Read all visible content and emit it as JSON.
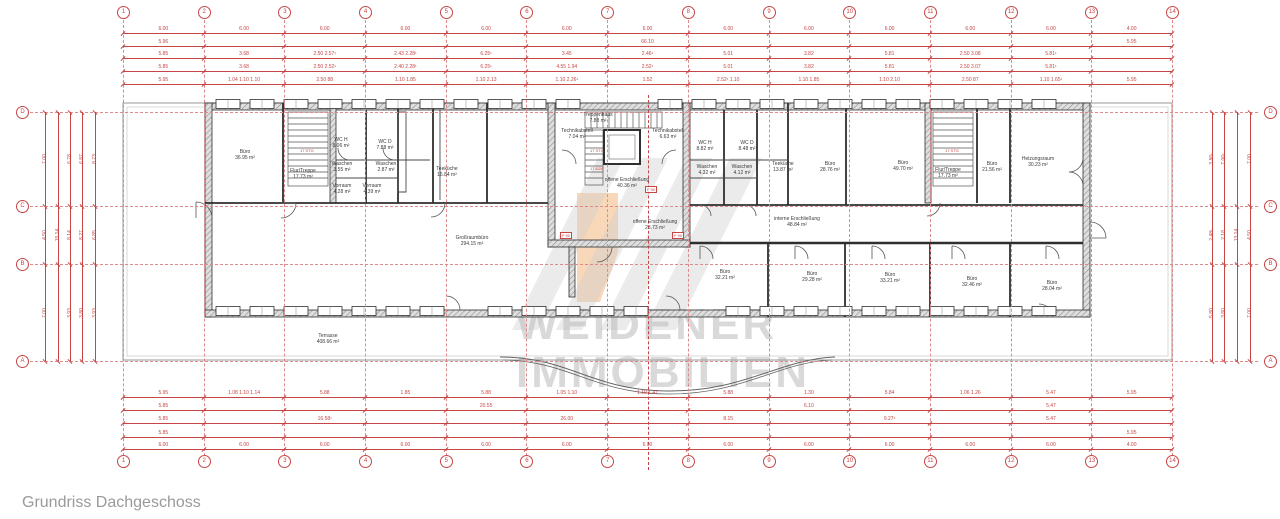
{
  "caption": "Grundriss Dachgeschoss",
  "watermark": {
    "line1": "WEIDENER",
    "line2": "IMMOBILIEN"
  },
  "colors": {
    "dim_red": "#c64545",
    "dash_red": "#dc8a8a",
    "wall_dark": "#2f2f2f",
    "outline_gray": "#999999",
    "watermark_gray": "#bdbdbd",
    "watermark_orange": "#f2a764",
    "caption_gray": "#9a9a9a"
  },
  "grid": {
    "columns": [
      "1",
      "2",
      "3",
      "4",
      "5",
      "6",
      "7",
      "8",
      "9",
      "10",
      "11",
      "12",
      "13",
      "14"
    ],
    "rows": [
      {
        "label": "D",
        "y": 112
      },
      {
        "label": "C",
        "y": 206
      },
      {
        "label": "B",
        "y": 264
      },
      {
        "label": "A",
        "y": 361
      }
    ]
  },
  "rooms": [
    {
      "name": "Büro",
      "area": "36.95 m²",
      "x": 245,
      "y": 154
    },
    {
      "name": "Flur/Treppe",
      "area": "17.73 m²",
      "x": 303,
      "y": 173
    },
    {
      "name": "WC H",
      "area": "8.06 m²",
      "x": 341,
      "y": 142
    },
    {
      "name": "WC D",
      "area": "7.88 m²",
      "x": 385,
      "y": 144
    },
    {
      "name": "Waschen",
      "area": "3.55 m²",
      "x": 342,
      "y": 166
    },
    {
      "name": "Waschen",
      "area": "2.87 m²",
      "x": 386,
      "y": 166
    },
    {
      "name": "Vorraum",
      "area": "4.28 m²",
      "x": 342,
      "y": 188
    },
    {
      "name": "Vorraum",
      "area": "4.39 m²",
      "x": 372,
      "y": 188
    },
    {
      "name": "Teeküche",
      "area": "16.84 m²",
      "x": 447,
      "y": 171
    },
    {
      "name": "Technikabstell",
      "area": "7.04 m²",
      "x": 577,
      "y": 133
    },
    {
      "name": "Treppenhaus",
      "area": "7.88 m²",
      "x": 598,
      "y": 117
    },
    {
      "name": "Technikabstell",
      "area": "6.63 m²",
      "x": 668,
      "y": 133
    },
    {
      "name": "offene Erschließung",
      "area": "40.36 m²",
      "x": 627,
      "y": 182
    },
    {
      "name": "offene Erschließung",
      "area": "23.73 m²",
      "x": 655,
      "y": 224
    },
    {
      "name": "interne Erschließung",
      "area": "48.84 m²",
      "x": 797,
      "y": 221
    },
    {
      "name": "WC H",
      "area": "8.82 m²",
      "x": 705,
      "y": 145
    },
    {
      "name": "WC D",
      "area": "8.48 m²",
      "x": 747,
      "y": 145
    },
    {
      "name": "Waschen",
      "area": "4.32 m²",
      "x": 707,
      "y": 169
    },
    {
      "name": "Waschen",
      "area": "4.12 m²",
      "x": 742,
      "y": 169
    },
    {
      "name": "Teeküche",
      "area": "13.87 m²",
      "x": 783,
      "y": 166
    },
    {
      "name": "Büro",
      "area": "28.76 m²",
      "x": 830,
      "y": 166
    },
    {
      "name": "Büro",
      "area": "49.70 m²",
      "x": 903,
      "y": 165
    },
    {
      "name": "Flur/Treppe",
      "area": "17.73 m²",
      "x": 948,
      "y": 172
    },
    {
      "name": "Büro",
      "area": "21.56 m²",
      "x": 992,
      "y": 166
    },
    {
      "name": "Heizungsraum",
      "area": "30.23 m²",
      "x": 1038,
      "y": 161
    },
    {
      "name": "Großraumbüro",
      "area": "294.15 m²",
      "x": 472,
      "y": 240
    },
    {
      "name": "Büro",
      "area": "32.21 m²",
      "x": 725,
      "y": 274
    },
    {
      "name": "Büro",
      "area": "29.28 m²",
      "x": 812,
      "y": 276
    },
    {
      "name": "Büro",
      "area": "33.21 m²",
      "x": 890,
      "y": 277
    },
    {
      "name": "Büro",
      "area": "32.46 m²",
      "x": 972,
      "y": 281
    },
    {
      "name": "Büro",
      "area": "28.04 m²",
      "x": 1052,
      "y": 285
    },
    {
      "name": "Terrasse",
      "area": "408.66 m²",
      "x": 328,
      "y": 338
    }
  ],
  "stair_notes": [
    {
      "text": "17 STG",
      "x": 300,
      "y": 148
    },
    {
      "text": "17 STG",
      "x": 590,
      "y": 148
    },
    {
      "text": "17.6/28",
      "x": 590,
      "y": 166
    },
    {
      "text": "17 STG",
      "x": 945,
      "y": 148
    }
  ],
  "marker_labels": [
    {
      "text": "F 90",
      "x": 560,
      "y": 232
    },
    {
      "text": "F 90",
      "x": 645,
      "y": 186
    },
    {
      "text": "F 90",
      "x": 672,
      "y": 232
    }
  ],
  "dims": {
    "top": [
      {
        "y": 33,
        "labels": [
          "6.00",
          "6.00",
          "6.00",
          "6.00",
          "6.00",
          "6.00",
          "6.00",
          "6.00",
          "6.00",
          "6.00",
          "6.00",
          "6.00",
          "4.00"
        ]
      },
      {
        "y": 46,
        "labels": [
          "5.96",
          "",
          "",
          "",
          "",
          "",
          "66.10",
          "",
          "",
          "",
          "",
          "",
          "5.95"
        ]
      },
      {
        "y": 58,
        "labels": [
          "5.85",
          "3.68",
          "2.50  2.57¹",
          "2.43  2.28¹",
          "6.25¹",
          "3.45",
          "2.46¹",
          "5.01",
          "3.82",
          "5.81",
          "2.50  3.08",
          "5.81¹",
          ""
        ]
      },
      {
        "y": 71,
        "labels": [
          "5.85",
          "3.68",
          "2.50  2.52¹",
          "2.40  2.28¹",
          "6.25¹",
          "4.55  1.94",
          "2.52¹",
          "5.01",
          "3.82",
          "5.81",
          "2.50  3.07",
          "5.81¹",
          ""
        ]
      },
      {
        "y": 84,
        "labels": [
          "5.95",
          "1.04  1.10  1.10",
          "2.50  88",
          "1.10  1.85",
          "1.10  2.13",
          "1.10  2.26¹",
          "1.52",
          "2.52¹  1.10",
          "1.10  1.85",
          "1.10  2.10",
          "2.50  87",
          "1.10  1.65¹",
          "5.95"
        ]
      }
    ],
    "bottom": [
      {
        "y": 397,
        "labels": [
          "5.95",
          "1.08  1.10  1.14",
          "5.88",
          "1.85",
          "5.88",
          "1.05  1.10",
          "1.10  1.47",
          "5.88",
          "1.30",
          "5.84",
          "1.06  1.26",
          "5.47",
          "5.95"
        ]
      },
      {
        "y": 410,
        "labels": [
          "5.85",
          "",
          "",
          "",
          "20.55",
          "",
          "",
          "",
          "6.10",
          "",
          "",
          "5.47",
          ""
        ]
      },
      {
        "y": 423,
        "labels": [
          "5.85",
          "",
          "16.58¹",
          "",
          "",
          "26.00",
          "",
          "8.15",
          "",
          "9.27¹",
          "",
          "5.47",
          ""
        ]
      },
      {
        "y": 437,
        "labels": [
          "5.85",
          "",
          "",
          "",
          "",
          "",
          "",
          "",
          "",
          "",
          "",
          "",
          "5.95"
        ]
      },
      {
        "y": 449,
        "labels": [
          "6.00",
          "6.00",
          "6.00",
          "6.00",
          "6.00",
          "6.00",
          "6.00",
          "6.00",
          "6.00",
          "6.00",
          "6.00",
          "6.00",
          "4.00"
        ]
      }
    ],
    "left": [
      {
        "x": 45,
        "labels": [
          "7.00",
          "4.50",
          "7.00"
        ]
      },
      {
        "x": 58,
        "labels": [
          "",
          "15.14",
          ""
        ]
      },
      {
        "x": 70,
        "labels": [
          "6.78",
          "8.14",
          "3.93"
        ]
      },
      {
        "x": 82,
        "labels": [
          "6.87",
          "8.27",
          "3.80"
        ]
      },
      {
        "x": 95,
        "labels": [
          "8.73",
          "6.85",
          "3.93"
        ]
      }
    ],
    "right": [
      {
        "x": 1212,
        "labels": [
          "3.86¹",
          "2.48¹",
          "5.80"
        ]
      },
      {
        "x": 1224,
        "labels": [
          "7.06¹",
          "2.18",
          "3.80"
        ]
      },
      {
        "x": 1237,
        "labels": [
          "",
          "13.14",
          ""
        ]
      },
      {
        "x": 1250,
        "labels": [
          "7.00",
          "4.50",
          "7.00"
        ]
      }
    ]
  }
}
